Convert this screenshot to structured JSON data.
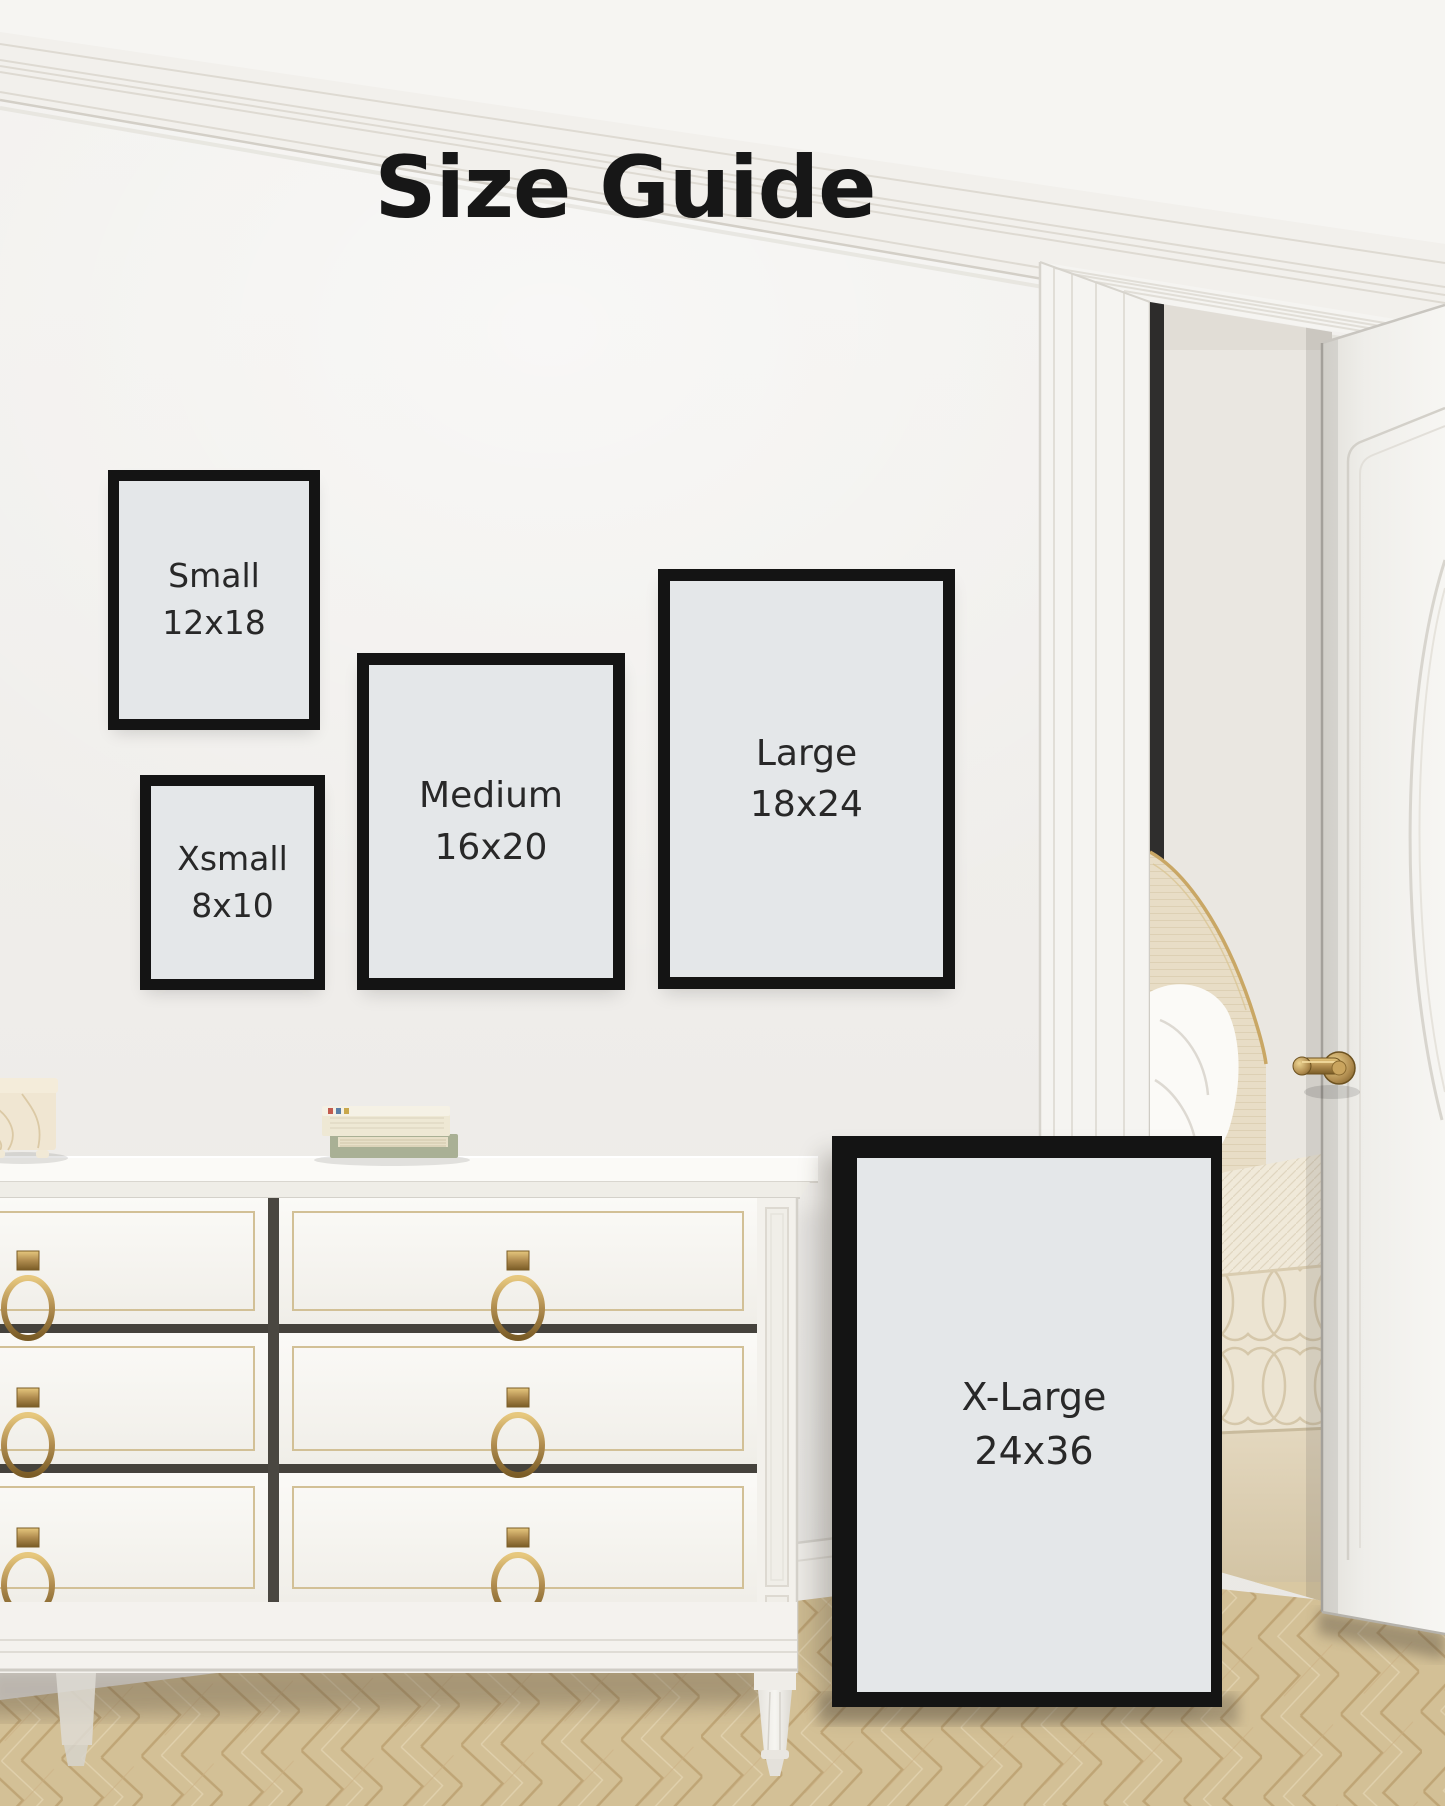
{
  "title": "Size Guide",
  "frames": [
    {
      "id": "small",
      "label": "Small",
      "dimensions": "12x18"
    },
    {
      "id": "xsmall",
      "label": "Xsmall",
      "dimensions": "8x10"
    },
    {
      "id": "medium",
      "label": "Medium",
      "dimensions": "16x20"
    },
    {
      "id": "large",
      "label": "Large",
      "dimensions": "18x24"
    },
    {
      "id": "xlarge",
      "label": "X-Large",
      "dimensions": "24x36"
    }
  ],
  "colors": {
    "frame_border": "#141414",
    "frame_mat": "#e4e7e9",
    "wall": "#efedea",
    "ceiling": "#f6f5f2",
    "floor_wood": "#d8c59c",
    "floor_grain": "#c1a778",
    "dresser_white": "#f6f5f1",
    "gold_trim": "#cfbc92",
    "brass_hardware": "#b08c4f",
    "door_white": "#f5f4f1",
    "bedding_cream": "#ece3d0",
    "headboard_linen": "#e8ddc6",
    "title_text": "#171717",
    "label_text": "#282828"
  },
  "scene_objects": [
    "crown-molding",
    "white-dresser",
    "brass-ring-pulls",
    "marble-box",
    "stacked-books",
    "herringbone-wood-floor",
    "door-casing",
    "open-white-door",
    "brass-door-handle",
    "bedroom-view",
    "upholstered-headboard",
    "white-pillow",
    "patterned-bedspread"
  ]
}
